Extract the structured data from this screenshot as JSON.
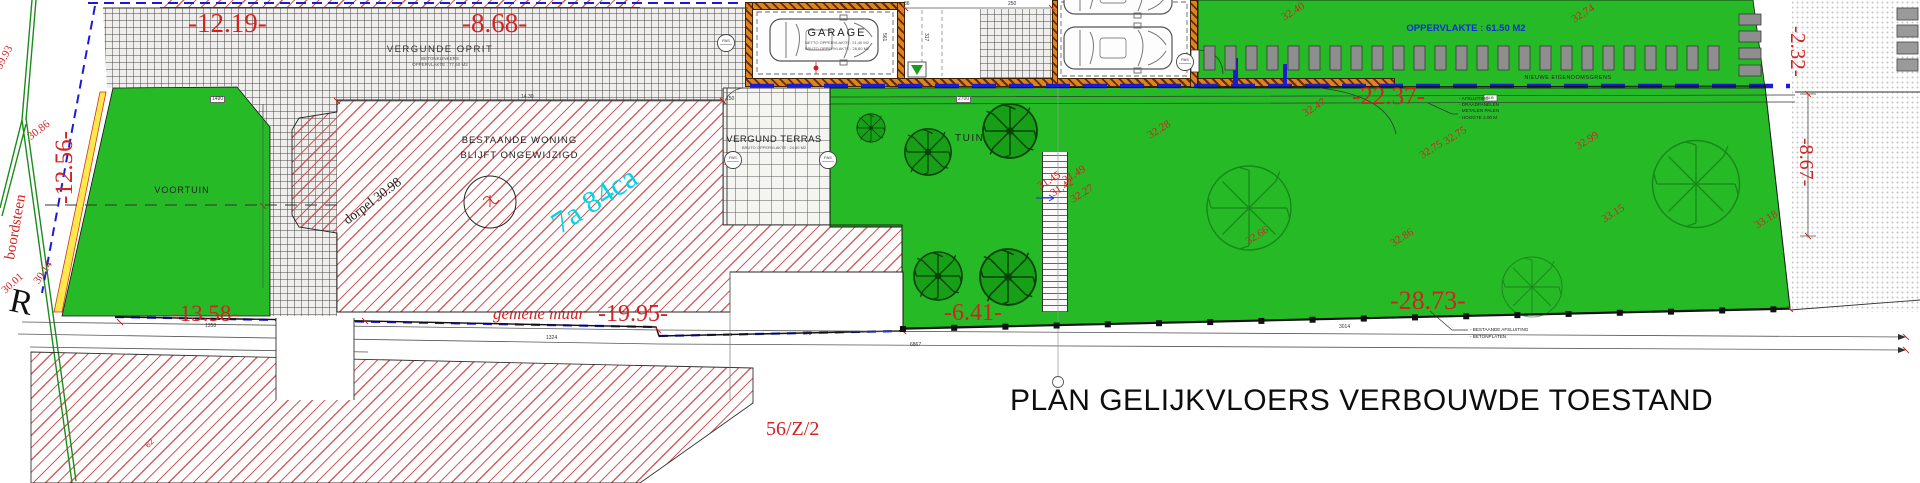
{
  "labels": {
    "title": "PLAN GELIJKVLOERS VERBOUWDE TOESTAND",
    "parcel_ref": "56/Z/2",
    "site_area": "7a 84ca",
    "driveway": "VERGUNDE OPRIT",
    "driveway_note1": "BETONKLINKERS",
    "driveway_note2": "OPPERVLAKTE : 77,60 M2",
    "front_garden": "VOORTUIN",
    "house_line1": "BESTAANDE WONING",
    "house_line2": "BLIJFT ONGEWIJZIGD",
    "threshold": "dorpel 30.98",
    "garage": "GARAGE",
    "garage_note1": "NETTO OPPERVLAKTE : 21,40 M2",
    "garage_note2": "BRUTO OPPERVLAKTE : 26,80 M2",
    "terrace": "VERGUND TERRAS",
    "terrace_note": "BRUTO OPPERVLAKTE : 24,60 M2",
    "garden": "TUIN",
    "strip_area": "OPPERVLAKTE : 61.50 M2",
    "new_boundary": "NIEUWE EIGENDOMSGRENS",
    "curb": "boordsteen",
    "street_monogram": "R",
    "neighbor_mark": "62",
    "pas": "PAS"
  },
  "fence_note": {
    "l1": "- AFSLUITING",
    "tag": "GLB",
    "l2": "- DRAADPANELEN",
    "l3": "- METALEN PALEN",
    "l4": "- HOOGTE 2.00 M"
  },
  "existing_fence_note": {
    "l1": "- BESTAANDE AFSLUITING",
    "l2": "- BETONPLATEN"
  },
  "dimensions": [
    {
      "t": "-12.19-",
      "x": 188,
      "y": 10,
      "fs": 27
    },
    {
      "t": "-8.68-",
      "x": 462,
      "y": 10,
      "fs": 27
    },
    {
      "t": "-12.56-",
      "x": 52,
      "y": 204,
      "fs": 25,
      "r": -90
    },
    {
      "t": "-13.58-",
      "x": 172,
      "y": 302,
      "fs": 23
    },
    {
      "t": "gemene muur",
      "x": 493,
      "y": 305,
      "fs": 17,
      "it": true
    },
    {
      "t": "-19.95-",
      "x": 598,
      "y": 302,
      "fs": 24
    },
    {
      "t": "-6.41-",
      "x": 944,
      "y": 301,
      "fs": 24
    },
    {
      "t": "-22.37-",
      "x": 1352,
      "y": 84,
      "fs": 25
    },
    {
      "t": "-28.73-",
      "x": 1390,
      "y": 288,
      "fs": 26
    },
    {
      "t": "-2.32-",
      "x": 1808,
      "y": 26,
      "fs": 21,
      "r": 90
    },
    {
      "t": "-8.67-",
      "x": 1816,
      "y": 138,
      "fs": 20,
      "r": 90
    }
  ],
  "elevations": [
    {
      "t": "39.93",
      "x": -6,
      "y": 66,
      "r": -62
    },
    {
      "t": "30.86",
      "x": 26,
      "y": 134,
      "r": -38
    },
    {
      "t": "30.01",
      "x": 0,
      "y": 288,
      "r": -42
    },
    {
      "t": "30.14",
      "x": 32,
      "y": 280,
      "r": -56
    },
    {
      "t": "32.40",
      "x": 1280,
      "y": 14,
      "r": -32
    },
    {
      "t": "32.74",
      "x": 1570,
      "y": 16,
      "r": -32
    },
    {
      "t": "32.28",
      "x": 1146,
      "y": 132,
      "r": -32
    },
    {
      "t": "32.47",
      "x": 1301,
      "y": 110,
      "r": -32
    },
    {
      "t": "32.27",
      "x": 1069,
      "y": 196,
      "r": -32
    },
    {
      "t": "31.45",
      "x": 1036,
      "y": 183,
      "r": -32
    },
    {
      "t": "31.42",
      "x": 1049,
      "y": 190,
      "r": -32
    },
    {
      "t": "31.49",
      "x": 1061,
      "y": 177,
      "r": -32
    },
    {
      "t": "32.75",
      "x": 1418,
      "y": 152,
      "r": -32
    },
    {
      "t": "32.75",
      "x": 1442,
      "y": 138,
      "r": -32
    },
    {
      "t": "32.66",
      "x": 1244,
      "y": 238,
      "r": -32
    },
    {
      "t": "32.86",
      "x": 1389,
      "y": 240,
      "r": -32
    },
    {
      "t": "32.99",
      "x": 1574,
      "y": 143,
      "r": -32
    },
    {
      "t": "33.15",
      "x": 1600,
      "y": 216,
      "r": -32
    },
    {
      "t": "33.18",
      "x": 1753,
      "y": 222,
      "r": -32
    }
  ],
  "small_dims": [
    {
      "t": "1358",
      "x": 205,
      "y": 324
    },
    {
      "t": "1324",
      "x": 546,
      "y": 336
    },
    {
      "t": "679",
      "x": 803,
      "y": 332
    },
    {
      "t": "6867",
      "x": 910,
      "y": 343
    },
    {
      "t": "3014",
      "x": 1339,
      "y": 325
    },
    {
      "t": "14.30",
      "x": 521,
      "y": 95
    },
    {
      "t": "150",
      "x": 726,
      "y": 97
    },
    {
      "t": "1490",
      "x": 210,
      "y": 96,
      "boxed": true
    },
    {
      "t": "2700",
      "x": 956,
      "y": 96,
      "boxed": true
    },
    {
      "t": "36",
      "x": 904,
      "y": 2
    },
    {
      "t": "250",
      "x": 1008,
      "y": 2
    },
    {
      "t": "317",
      "x": 928,
      "y": 33,
      "r": 90
    },
    {
      "t": "561",
      "x": 886,
      "y": 33,
      "r": 90
    }
  ],
  "colors": {
    "garden_green": "#26bb26",
    "tree_green": "#17a017",
    "hatch_red": "#cd4e4e",
    "wall_orange": "#e0831f",
    "boundary_blue": "#1b1bd6",
    "dim_red": "#d32222",
    "site_area_cyan": "#00d4e6"
  }
}
